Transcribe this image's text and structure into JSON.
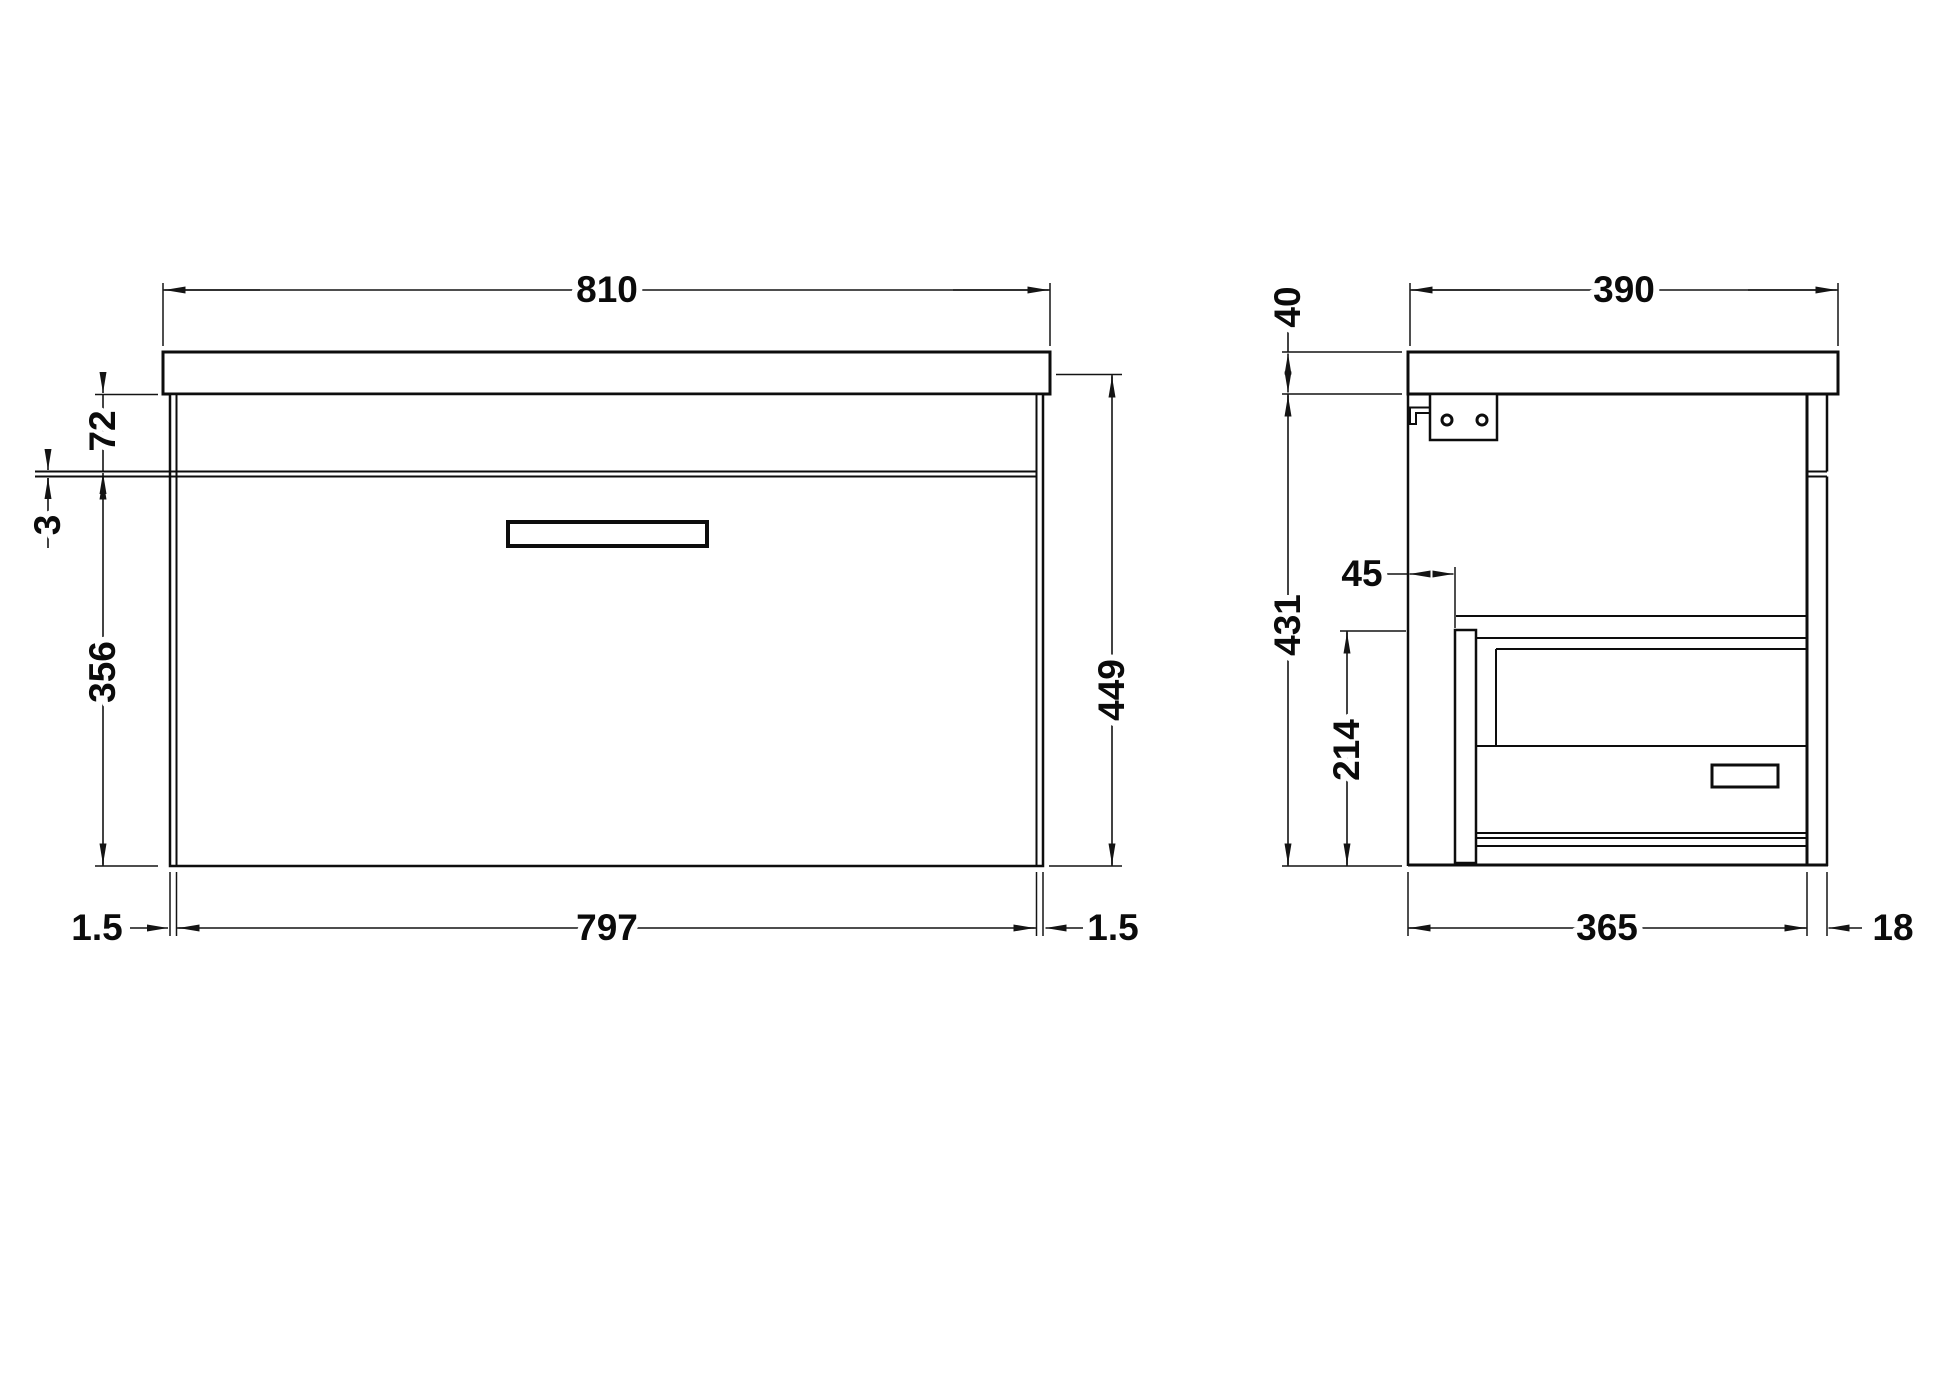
{
  "drawing": {
    "title": "wall-hung vanity unit dimension drawing",
    "units": "mm",
    "front": {
      "overall_width": "810",
      "top_height": "72",
      "groove_gap": "3",
      "drawer_front_height": "356",
      "overall_height": "449",
      "drawer_front_width": "797",
      "side_gap_left": "1.5",
      "side_gap_right": "1.5"
    },
    "side": {
      "worktop_thickness": "40",
      "overall_depth": "390",
      "back_inset": "45",
      "unit_height": "431",
      "drawer_back_height": "214",
      "carcass_depth": "365",
      "front_panel_thickness": "18"
    }
  }
}
